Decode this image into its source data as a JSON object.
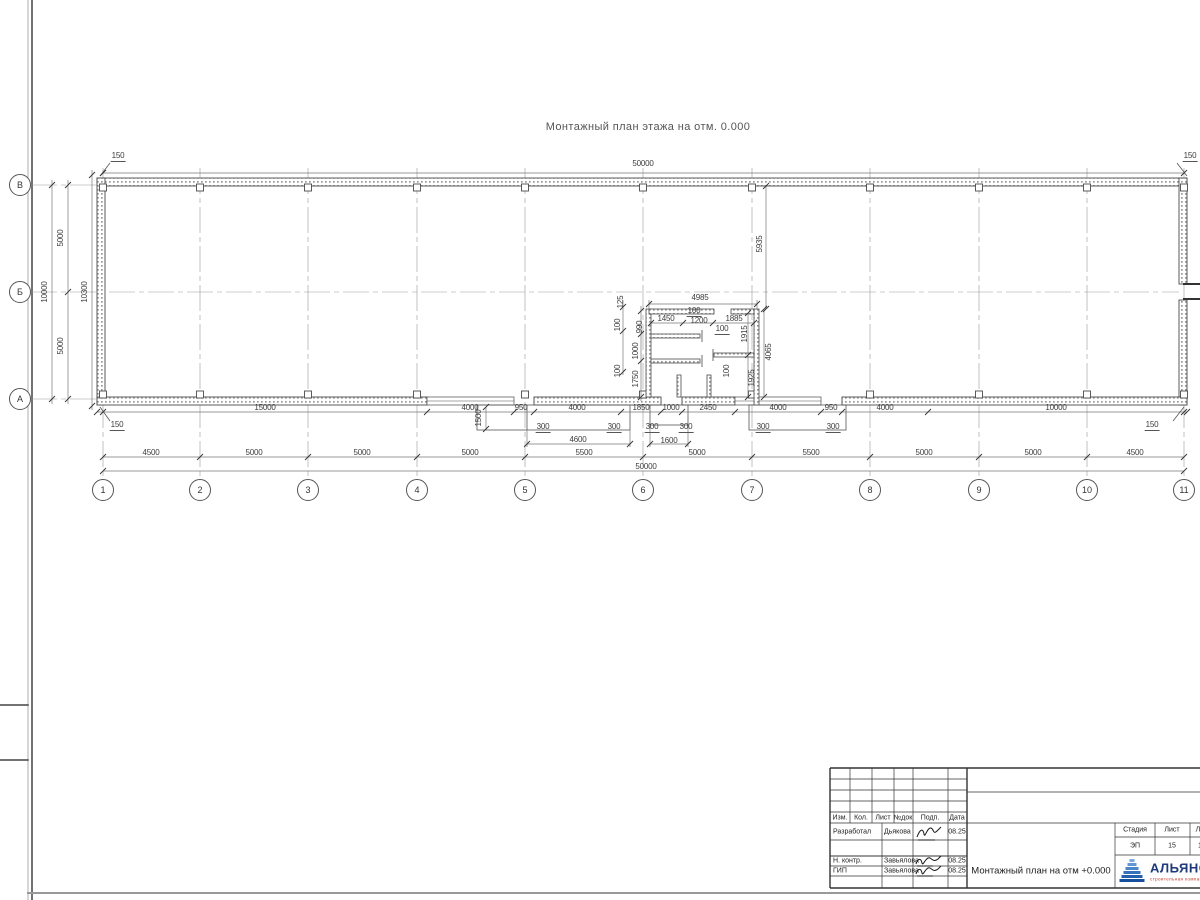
{
  "sheet_title": "Монтажный план этажа на отм. 0.000",
  "axis_markers": {
    "bottom": [
      {
        "label": "1",
        "x": 103
      },
      {
        "label": "2",
        "x": 200
      },
      {
        "label": "3",
        "x": 308
      },
      {
        "label": "4",
        "x": 417
      },
      {
        "label": "5",
        "x": 525
      },
      {
        "label": "6",
        "x": 643
      },
      {
        "label": "7",
        "x": 752
      },
      {
        "label": "8",
        "x": 870
      },
      {
        "label": "9",
        "x": 979
      },
      {
        "label": "10",
        "x": 1087
      },
      {
        "label": "11",
        "x": 1184
      }
    ],
    "left": [
      {
        "label": "В",
        "y": 185
      },
      {
        "label": "Б",
        "y": 292
      },
      {
        "label": "А",
        "y": 399
      }
    ]
  },
  "dim_labels": [
    {
      "text": "50000",
      "x": 643,
      "y": 164
    },
    {
      "text": "150",
      "x": 118,
      "y": 157,
      "u": 1
    },
    {
      "text": "150",
      "x": 1190,
      "y": 157,
      "u": 1
    },
    {
      "text": "5000",
      "x": 61,
      "y": 238,
      "rot": -90
    },
    {
      "text": "5000",
      "x": 61,
      "y": 346,
      "rot": -90
    },
    {
      "text": "10000",
      "x": 45,
      "y": 292,
      "rot": -90
    },
    {
      "text": "10300",
      "x": 85,
      "y": 292,
      "rot": -90
    },
    {
      "text": "5935",
      "x": 760,
      "y": 244,
      "rot": -90
    },
    {
      "text": "4985",
      "x": 700,
      "y": 298
    },
    {
      "text": "125",
      "x": 621,
      "y": 302,
      "rot": -90
    },
    {
      "text": "100",
      "x": 618,
      "y": 325,
      "rot": -90
    },
    {
      "text": "990",
      "x": 640,
      "y": 327,
      "rot": -90
    },
    {
      "text": "1000",
      "x": 636,
      "y": 351,
      "rot": -90
    },
    {
      "text": "100",
      "x": 618,
      "y": 371,
      "rot": -90
    },
    {
      "text": "1750",
      "x": 636,
      "y": 379,
      "rot": -90
    },
    {
      "text": "1450",
      "x": 666,
      "y": 319
    },
    {
      "text": "100",
      "x": 694,
      "y": 312,
      "u": 1
    },
    {
      "text": "1200",
      "x": 699,
      "y": 321
    },
    {
      "text": "1885",
      "x": 734,
      "y": 319
    },
    {
      "text": "100",
      "x": 722,
      "y": 330,
      "u": 1
    },
    {
      "text": "1915",
      "x": 745,
      "y": 334,
      "rot": -90
    },
    {
      "text": "4065",
      "x": 769,
      "y": 352,
      "rot": -90
    },
    {
      "text": "100",
      "x": 727,
      "y": 371,
      "rot": -90
    },
    {
      "text": "1925",
      "x": 752,
      "y": 378,
      "rot": -90
    },
    {
      "text": "15000",
      "x": 265,
      "y": 408
    },
    {
      "text": "4000",
      "x": 470,
      "y": 408
    },
    {
      "text": "950",
      "x": 521,
      "y": 408
    },
    {
      "text": "4000",
      "x": 577,
      "y": 408
    },
    {
      "text": "1850",
      "x": 641,
      "y": 408
    },
    {
      "text": "1000",
      "x": 671,
      "y": 408
    },
    {
      "text": "2450",
      "x": 708,
      "y": 408
    },
    {
      "text": "4000",
      "x": 778,
      "y": 408
    },
    {
      "text": "950",
      "x": 831,
      "y": 408
    },
    {
      "text": "4000",
      "x": 885,
      "y": 408
    },
    {
      "text": "10000",
      "x": 1056,
      "y": 408
    },
    {
      "text": "150",
      "x": 117,
      "y": 426,
      "u": 1
    },
    {
      "text": "150",
      "x": 1152,
      "y": 426,
      "u": 1
    },
    {
      "text": "1500",
      "x": 479,
      "y": 418,
      "rot": -90
    },
    {
      "text": "300",
      "x": 543,
      "y": 428,
      "u": 1
    },
    {
      "text": "300",
      "x": 614,
      "y": 428,
      "u": 1
    },
    {
      "text": "4600",
      "x": 578,
      "y": 440
    },
    {
      "text": "300",
      "x": 652,
      "y": 428,
      "u": 1
    },
    {
      "text": "300",
      "x": 686,
      "y": 428,
      "u": 1
    },
    {
      "text": "1600",
      "x": 669,
      "y": 441
    },
    {
      "text": "300",
      "x": 763,
      "y": 428,
      "u": 1
    },
    {
      "text": "300",
      "x": 833,
      "y": 428,
      "u": 1
    },
    {
      "text": "4500",
      "x": 151,
      "y": 453
    },
    {
      "text": "5000",
      "x": 254,
      "y": 453
    },
    {
      "text": "5000",
      "x": 362,
      "y": 453
    },
    {
      "text": "5000",
      "x": 470,
      "y": 453
    },
    {
      "text": "5500",
      "x": 584,
      "y": 453
    },
    {
      "text": "5000",
      "x": 697,
      "y": 453
    },
    {
      "text": "5500",
      "x": 811,
      "y": 453
    },
    {
      "text": "5000",
      "x": 924,
      "y": 453
    },
    {
      "text": "5000",
      "x": 1033,
      "y": 453
    },
    {
      "text": "4500",
      "x": 1135,
      "y": 453
    },
    {
      "text": "50000",
      "x": 646,
      "y": 467
    }
  ],
  "title_block": {
    "change_table_headers": [
      "Изм.",
      "Кол.",
      "Лист",
      "№док",
      "Подп.",
      "Дата"
    ],
    "signature_rows": [
      {
        "role": "Разработал",
        "name": "Дьякова",
        "date": "08.25"
      },
      {
        "role": "Н. контр.",
        "name": "Завьялова",
        "date": "08.25"
      },
      {
        "role": "ГИП",
        "name": "Завьялова",
        "date": "08.25"
      }
    ],
    "stage_table": {
      "headers": [
        "Стадия",
        "Лист",
        "Листов"
      ],
      "values": [
        "ЭП",
        "15",
        "1"
      ]
    },
    "doc_title": "Монтажный план на отм +0.000",
    "logo": {
      "company": "АЛЬЯНС",
      "tagline": "строительная компания"
    }
  },
  "colors": {
    "line": "#4a4a4a",
    "dim_text": "#3d3d3d",
    "logo_blue": "#2560ae",
    "logo_text": "#1e3a7a",
    "logo_red": "#c0392b"
  }
}
